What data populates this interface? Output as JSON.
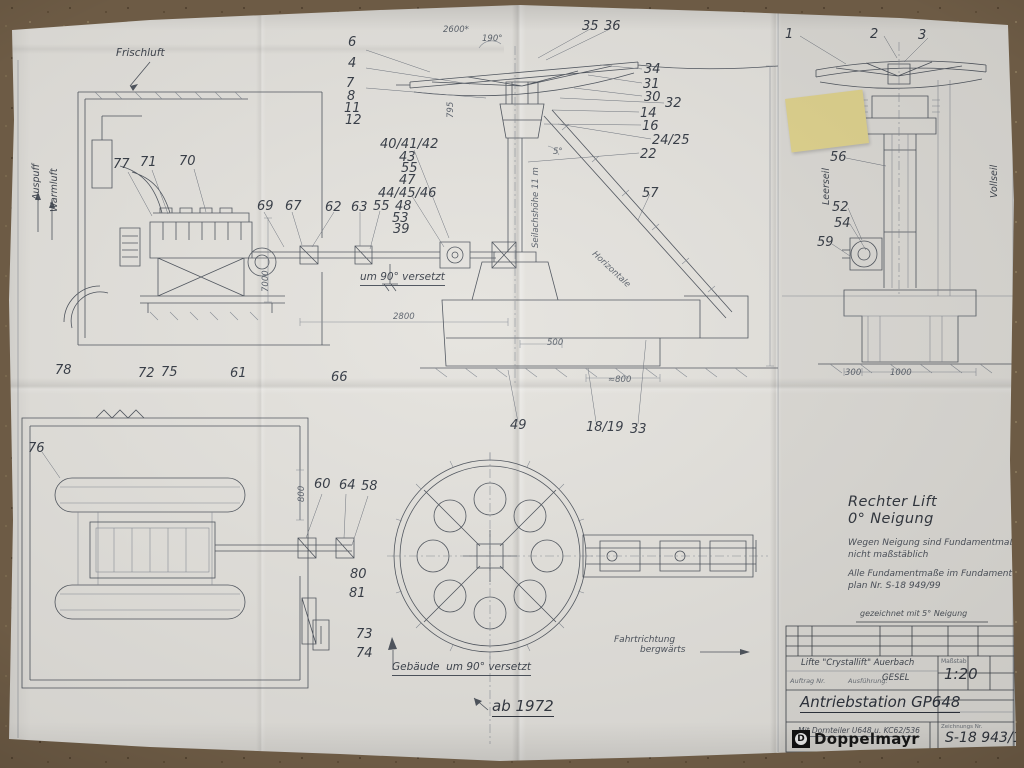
{
  "colors": {
    "paper": "#e5e3de",
    "carpet": "#6d5b45",
    "ink": "#4d535c",
    "sticky_note": "#e9dc92"
  },
  "labels": [
    {
      "t": "6",
      "x": 348,
      "y": 36
    },
    {
      "t": "4",
      "x": 348,
      "y": 57
    },
    {
      "t": "7",
      "x": 346,
      "y": 77
    },
    {
      "t": "8",
      "x": 347,
      "y": 90
    },
    {
      "t": "11",
      "x": 344,
      "y": 102
    },
    {
      "t": "12",
      "x": 345,
      "y": 114
    },
    {
      "t": "40/41/42",
      "x": 380,
      "y": 138
    },
    {
      "t": "43",
      "x": 399,
      "y": 151
    },
    {
      "t": "55",
      "x": 401,
      "y": 162
    },
    {
      "t": "47",
      "x": 399,
      "y": 174
    },
    {
      "t": "44/45/46",
      "x": 378,
      "y": 187
    },
    {
      "t": "48",
      "x": 395,
      "y": 200
    },
    {
      "t": "53",
      "x": 392,
      "y": 212
    },
    {
      "t": "39",
      "x": 393,
      "y": 223
    },
    {
      "t": "77",
      "x": 113,
      "y": 158
    },
    {
      "t": "71",
      "x": 140,
      "y": 156
    },
    {
      "t": "70",
      "x": 179,
      "y": 155
    },
    {
      "t": "69",
      "x": 257,
      "y": 200
    },
    {
      "t": "67",
      "x": 285,
      "y": 200
    },
    {
      "t": "62",
      "x": 325,
      "y": 201
    },
    {
      "t": "63",
      "x": 351,
      "y": 201
    },
    {
      "t": "55",
      "x": 373,
      "y": 200
    },
    {
      "t": "35",
      "x": 582,
      "y": 20
    },
    {
      "t": "36",
      "x": 604,
      "y": 20
    },
    {
      "t": "34",
      "x": 644,
      "y": 63
    },
    {
      "t": "31",
      "x": 643,
      "y": 78
    },
    {
      "t": "30",
      "x": 644,
      "y": 91
    },
    {
      "t": "32",
      "x": 665,
      "y": 97
    },
    {
      "t": "14",
      "x": 640,
      "y": 107
    },
    {
      "t": "16",
      "x": 642,
      "y": 120
    },
    {
      "t": "24/25",
      "x": 652,
      "y": 134
    },
    {
      "t": "22",
      "x": 640,
      "y": 148
    },
    {
      "t": "57",
      "x": 642,
      "y": 187
    },
    {
      "t": "1",
      "x": 785,
      "y": 28
    },
    {
      "t": "2",
      "x": 870,
      "y": 28
    },
    {
      "t": "3",
      "x": 918,
      "y": 29
    },
    {
      "t": "56",
      "x": 830,
      "y": 151
    },
    {
      "t": "52",
      "x": 832,
      "y": 201
    },
    {
      "t": "54",
      "x": 834,
      "y": 217
    },
    {
      "t": "59",
      "x": 817,
      "y": 236
    },
    {
      "t": "78",
      "x": 55,
      "y": 364
    },
    {
      "t": "72",
      "x": 138,
      "y": 367
    },
    {
      "t": "75",
      "x": 161,
      "y": 366
    },
    {
      "t": "61",
      "x": 230,
      "y": 367
    },
    {
      "t": "66",
      "x": 331,
      "y": 371
    },
    {
      "t": "49",
      "x": 510,
      "y": 419
    },
    {
      "t": "18/19",
      "x": 586,
      "y": 421
    },
    {
      "t": "33",
      "x": 630,
      "y": 423
    },
    {
      "t": "76",
      "x": 28,
      "y": 442
    },
    {
      "t": "60",
      "x": 314,
      "y": 478
    },
    {
      "t": "64",
      "x": 339,
      "y": 479
    },
    {
      "t": "58",
      "x": 361,
      "y": 480
    },
    {
      "t": "80",
      "x": 350,
      "y": 568
    },
    {
      "t": "81",
      "x": 349,
      "y": 587
    },
    {
      "t": "73",
      "x": 356,
      "y": 628
    },
    {
      "t": "74",
      "x": 356,
      "y": 647
    },
    {
      "t": "Frischluft",
      "x": 116,
      "y": 48,
      "kind": "note"
    },
    {
      "t": "Auspuff",
      "x": 32,
      "y": 200,
      "kind": "vnote",
      "rot": -90
    },
    {
      "t": "Warmluft",
      "x": 50,
      "y": 212,
      "kind": "vnote",
      "rot": -90
    },
    {
      "t": "um 90° versetzt",
      "x": 360,
      "y": 272,
      "kind": "noteu"
    },
    {
      "t": "Gebäude  um 90° versetzt",
      "x": 392,
      "y": 662,
      "kind": "noteu"
    },
    {
      "t": "ab 1972",
      "x": 492,
      "y": 698,
      "kind": "handbig"
    },
    {
      "t": "Fahrtrichtung",
      "x": 614,
      "y": 636,
      "kind": "hand"
    },
    {
      "t": "bergwärts",
      "x": 640,
      "y": 646,
      "kind": "hand"
    },
    {
      "t": "Leerseil",
      "x": 822,
      "y": 205,
      "kind": "vnote",
      "rot": -90
    },
    {
      "t": "Vollseil",
      "x": 990,
      "y": 198,
      "kind": "vnote",
      "rot": -90
    },
    {
      "t": "Seilachshöhe 11 m",
      "x": 532,
      "y": 248,
      "kind": "vdim",
      "rot": -90
    },
    {
      "t": "Horizontale",
      "x": 596,
      "y": 250,
      "kind": "dim",
      "rot": 43
    },
    {
      "t": "2600*",
      "x": 443,
      "y": 26,
      "kind": "dim"
    },
    {
      "t": "190°",
      "x": 482,
      "y": 35,
      "kind": "dim"
    },
    {
      "t": "795",
      "x": 447,
      "y": 118,
      "kind": "vdim",
      "rot": -90
    },
    {
      "t": "5°",
      "x": 553,
      "y": 148,
      "kind": "dim"
    },
    {
      "t": "7000",
      "x": 262,
      "y": 292,
      "kind": "vdim",
      "rot": -90
    },
    {
      "t": "2800",
      "x": 393,
      "y": 313,
      "kind": "dim"
    },
    {
      "t": "500",
      "x": 547,
      "y": 339,
      "kind": "dim"
    },
    {
      "t": "≈800",
      "x": 608,
      "y": 376,
      "kind": "dim"
    },
    {
      "t": "300",
      "x": 845,
      "y": 369,
      "kind": "dim"
    },
    {
      "t": "1000",
      "x": 890,
      "y": 369,
      "kind": "dim"
    },
    {
      "t": "800",
      "x": 298,
      "y": 502,
      "kind": "vdim",
      "rot": -90
    }
  ],
  "side_note": {
    "line1": "Rechter Lift",
    "line2": "0° Neigung",
    "para1a": "Wegen Neigung sind Fundamentmaße",
    "para1b": "nicht  maßstäblich",
    "para2a": "Alle Fundamentmaße im Fundament-",
    "para2b": "plan Nr.  S-18 949/99"
  },
  "title_block": {
    "note_above": "gezeichnet mit 5° Neigung",
    "handwritten_line": "Lifte \"Crystallift\" Auerbach",
    "auftrag_label": "Auftrag Nr.",
    "ausfuehrung_label": "Ausführung:",
    "ausfuehrung_value": "GESEL",
    "scale_label": "Maßstab",
    "scale_value": "1:20",
    "title": "Antriebstation GP648",
    "subtitle": "Mit Dornteiler U648 u. KC62/536",
    "company": "Doppelmayr",
    "logo_letter": "D",
    "drawing_number_label": "Zeichnungs Nr.",
    "drawing_number": "S-18 943/1"
  }
}
